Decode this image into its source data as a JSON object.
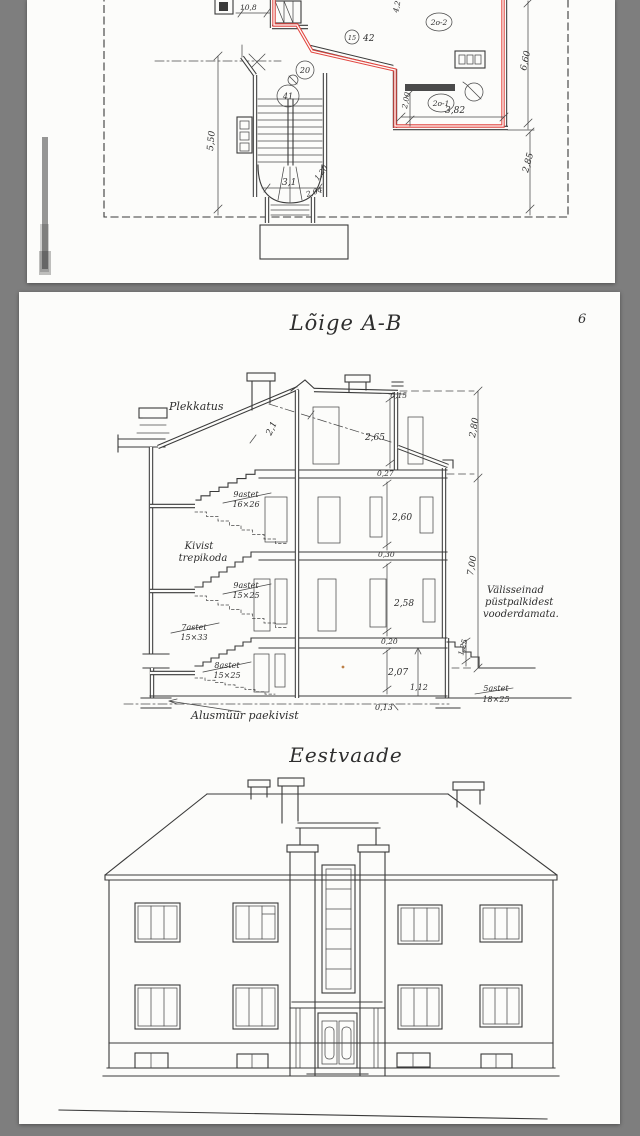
{
  "colors": {
    "background": "#7e7e7e",
    "page": "#fcfcfa",
    "ink": "#3a3a3a",
    "red": "#e2453f"
  },
  "page1": {
    "dims": {
      "w_top": "10,8",
      "w_red": "4,2",
      "h_right_upper": "6,60",
      "h_left": "5,50",
      "w_closet": "2,00",
      "w_room": "3,82",
      "h_right_lower": "2,85",
      "w_stair": "3,1",
      "diag_a": "1,20",
      "diag_b": "2,04"
    },
    "rooms": {
      "hall": "41",
      "stair": "20",
      "vestibule": "42",
      "door": "15",
      "room1": "2o-1",
      "room2": "2o-2"
    }
  },
  "page2": {
    "page_number": "6",
    "section": {
      "title": "Lõige A-B",
      "roof_label": "Plekkatus",
      "stairwell_label_1": "Kivist",
      "stairwell_label_2": "trepikoda",
      "wall_note_1": "Välisseinad",
      "wall_note_2": "püstpalkidest",
      "wall_note_3": "vooderdamata.",
      "foundation_note": "Alusmüür paekivist",
      "stairs": {
        "f1_count": "9astet",
        "f1_size": "16×26",
        "f2_count": "9astet",
        "f2_size": "15×25",
        "f3_count": "7astet",
        "f3_size": "15×33",
        "f4_count": "8astet",
        "f4_size": "15×25",
        "f5_count": "5astet",
        "f5_size": "18×25"
      },
      "dims": {
        "parapet": "0,15",
        "attic": "2,65",
        "upper": "2,80",
        "roof": "2,1",
        "slab1": "0,27",
        "floor2": "2,60",
        "slab2": "0,30",
        "floor1": "2,58",
        "total": "7,00",
        "slab3": "0,20",
        "basement": "2,07",
        "plinth": "1,12",
        "steps": "1,25",
        "slab4": "0,13"
      }
    },
    "elevation": {
      "title": "Eestvaade"
    }
  }
}
